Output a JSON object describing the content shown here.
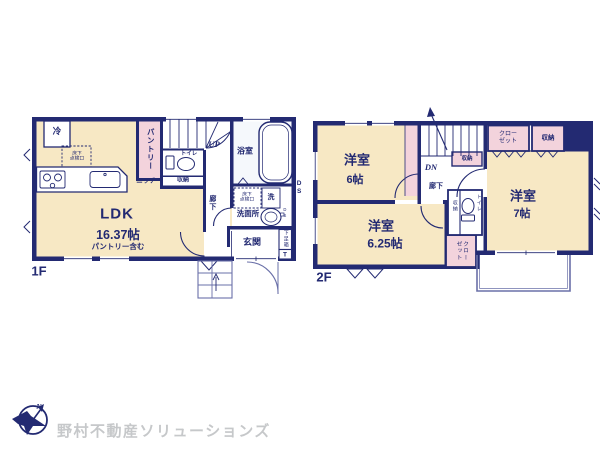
{
  "floor1": {
    "label": "1F",
    "ldk_name": "LDK",
    "ldk_size": "16.37帖",
    "ldk_note": "パントリー含む",
    "fridge": "冷",
    "hatch_kitchen": "床下\n点検口",
    "pantry": "パントリー",
    "niche": "ニッチ",
    "stairs_up": "UP",
    "toilet": "トイレ",
    "storage": "収納",
    "hallway": "廊下",
    "bath": "浴室",
    "hatch_wash": "床下\n点検口",
    "washer": "洗",
    "washroom": "洗面所",
    "ds_inner": "DS",
    "ds_outer": "DS",
    "entrance": "玄関",
    "shoebox": "下足箱",
    "shoebox_t": "T"
  },
  "floor2": {
    "label": "2F",
    "bed1_name": "洋室",
    "bed1_size": "6帖",
    "bed2_name": "洋室",
    "bed2_size": "6.25帖",
    "bed3_name": "洋室",
    "bed3_size": "7帖",
    "stairs_dn": "DN",
    "hallway": "廊下",
    "storage_stairs": "収納",
    "closet_top": "クロー\nゼット",
    "storage_top": "収納",
    "storage_mid": "収納",
    "toilet": "トイレ",
    "closet_mid": "クロー\nゼット"
  },
  "logo": {
    "north": "N",
    "company": "野村不動産ソリューションズ"
  },
  "colors": {
    "wall_navy": "#232a72",
    "room_cream": "#f7e8c4",
    "closet_pink": "#f3d3dc",
    "bath_tint": "#f5f8fc",
    "logo_gray": "#c6c8ca"
  }
}
